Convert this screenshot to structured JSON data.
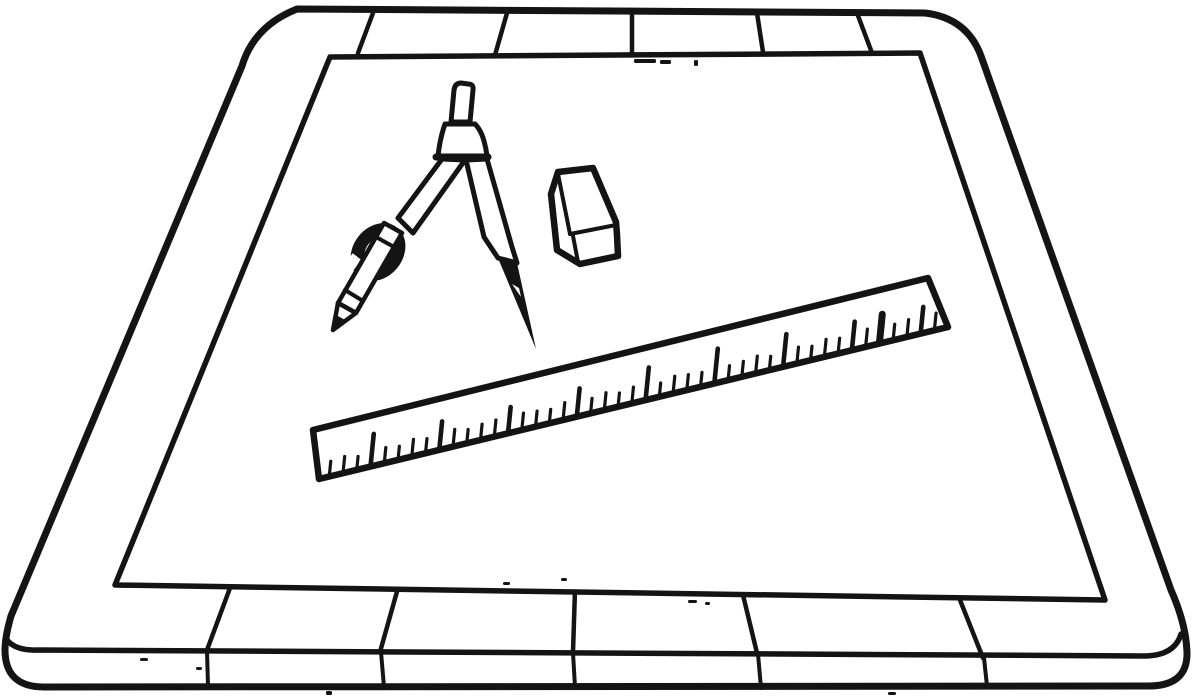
{
  "scene": {
    "description": "Black-and-white line-art illustration of a drafting drawing board with a wooden plank frame, a large sheet of paper, and drafting tools lying on it: a bow compass with pencil attachment, a block eraser, and a long ruler placed diagonally.",
    "background_color": "#ffffff",
    "ink_color": "#141414",
    "objects": [
      {
        "label": "Drawing board with plank frame"
      },
      {
        "label": "Sheet of drafting paper"
      },
      {
        "label": "Drafting compass with pencil attachment"
      },
      {
        "label": "Block eraser"
      },
      {
        "label": "Ruler with tick marks"
      }
    ]
  },
  "ruler": {
    "edge_start": [
      322,
      476
    ],
    "edge_end": [
      944,
      325
    ],
    "tick_count": 45,
    "first_t": 0.012,
    "last_t": 0.985,
    "major_every": 5,
    "major_phase": 3,
    "minor_len": 13,
    "major_len": 28,
    "minor_width": 3.2,
    "major_width": 4.6,
    "bold_index": 40,
    "bold_len": 30,
    "bold_width": 7,
    "lean": 0.1
  },
  "specks": [
    [
      634,
      59,
      22,
      4
    ],
    [
      660,
      60,
      11,
      4
    ],
    [
      694,
      60,
      4,
      6
    ],
    [
      503,
      582,
      7,
      3
    ],
    [
      561,
      578,
      6,
      3
    ],
    [
      688,
      600,
      9,
      3
    ],
    [
      705,
      602,
      5,
      3
    ],
    [
      140,
      658,
      8,
      3
    ],
    [
      196,
      667,
      6,
      3
    ],
    [
      326,
      691,
      6,
      4
    ],
    [
      888,
      692,
      8,
      3
    ]
  ]
}
